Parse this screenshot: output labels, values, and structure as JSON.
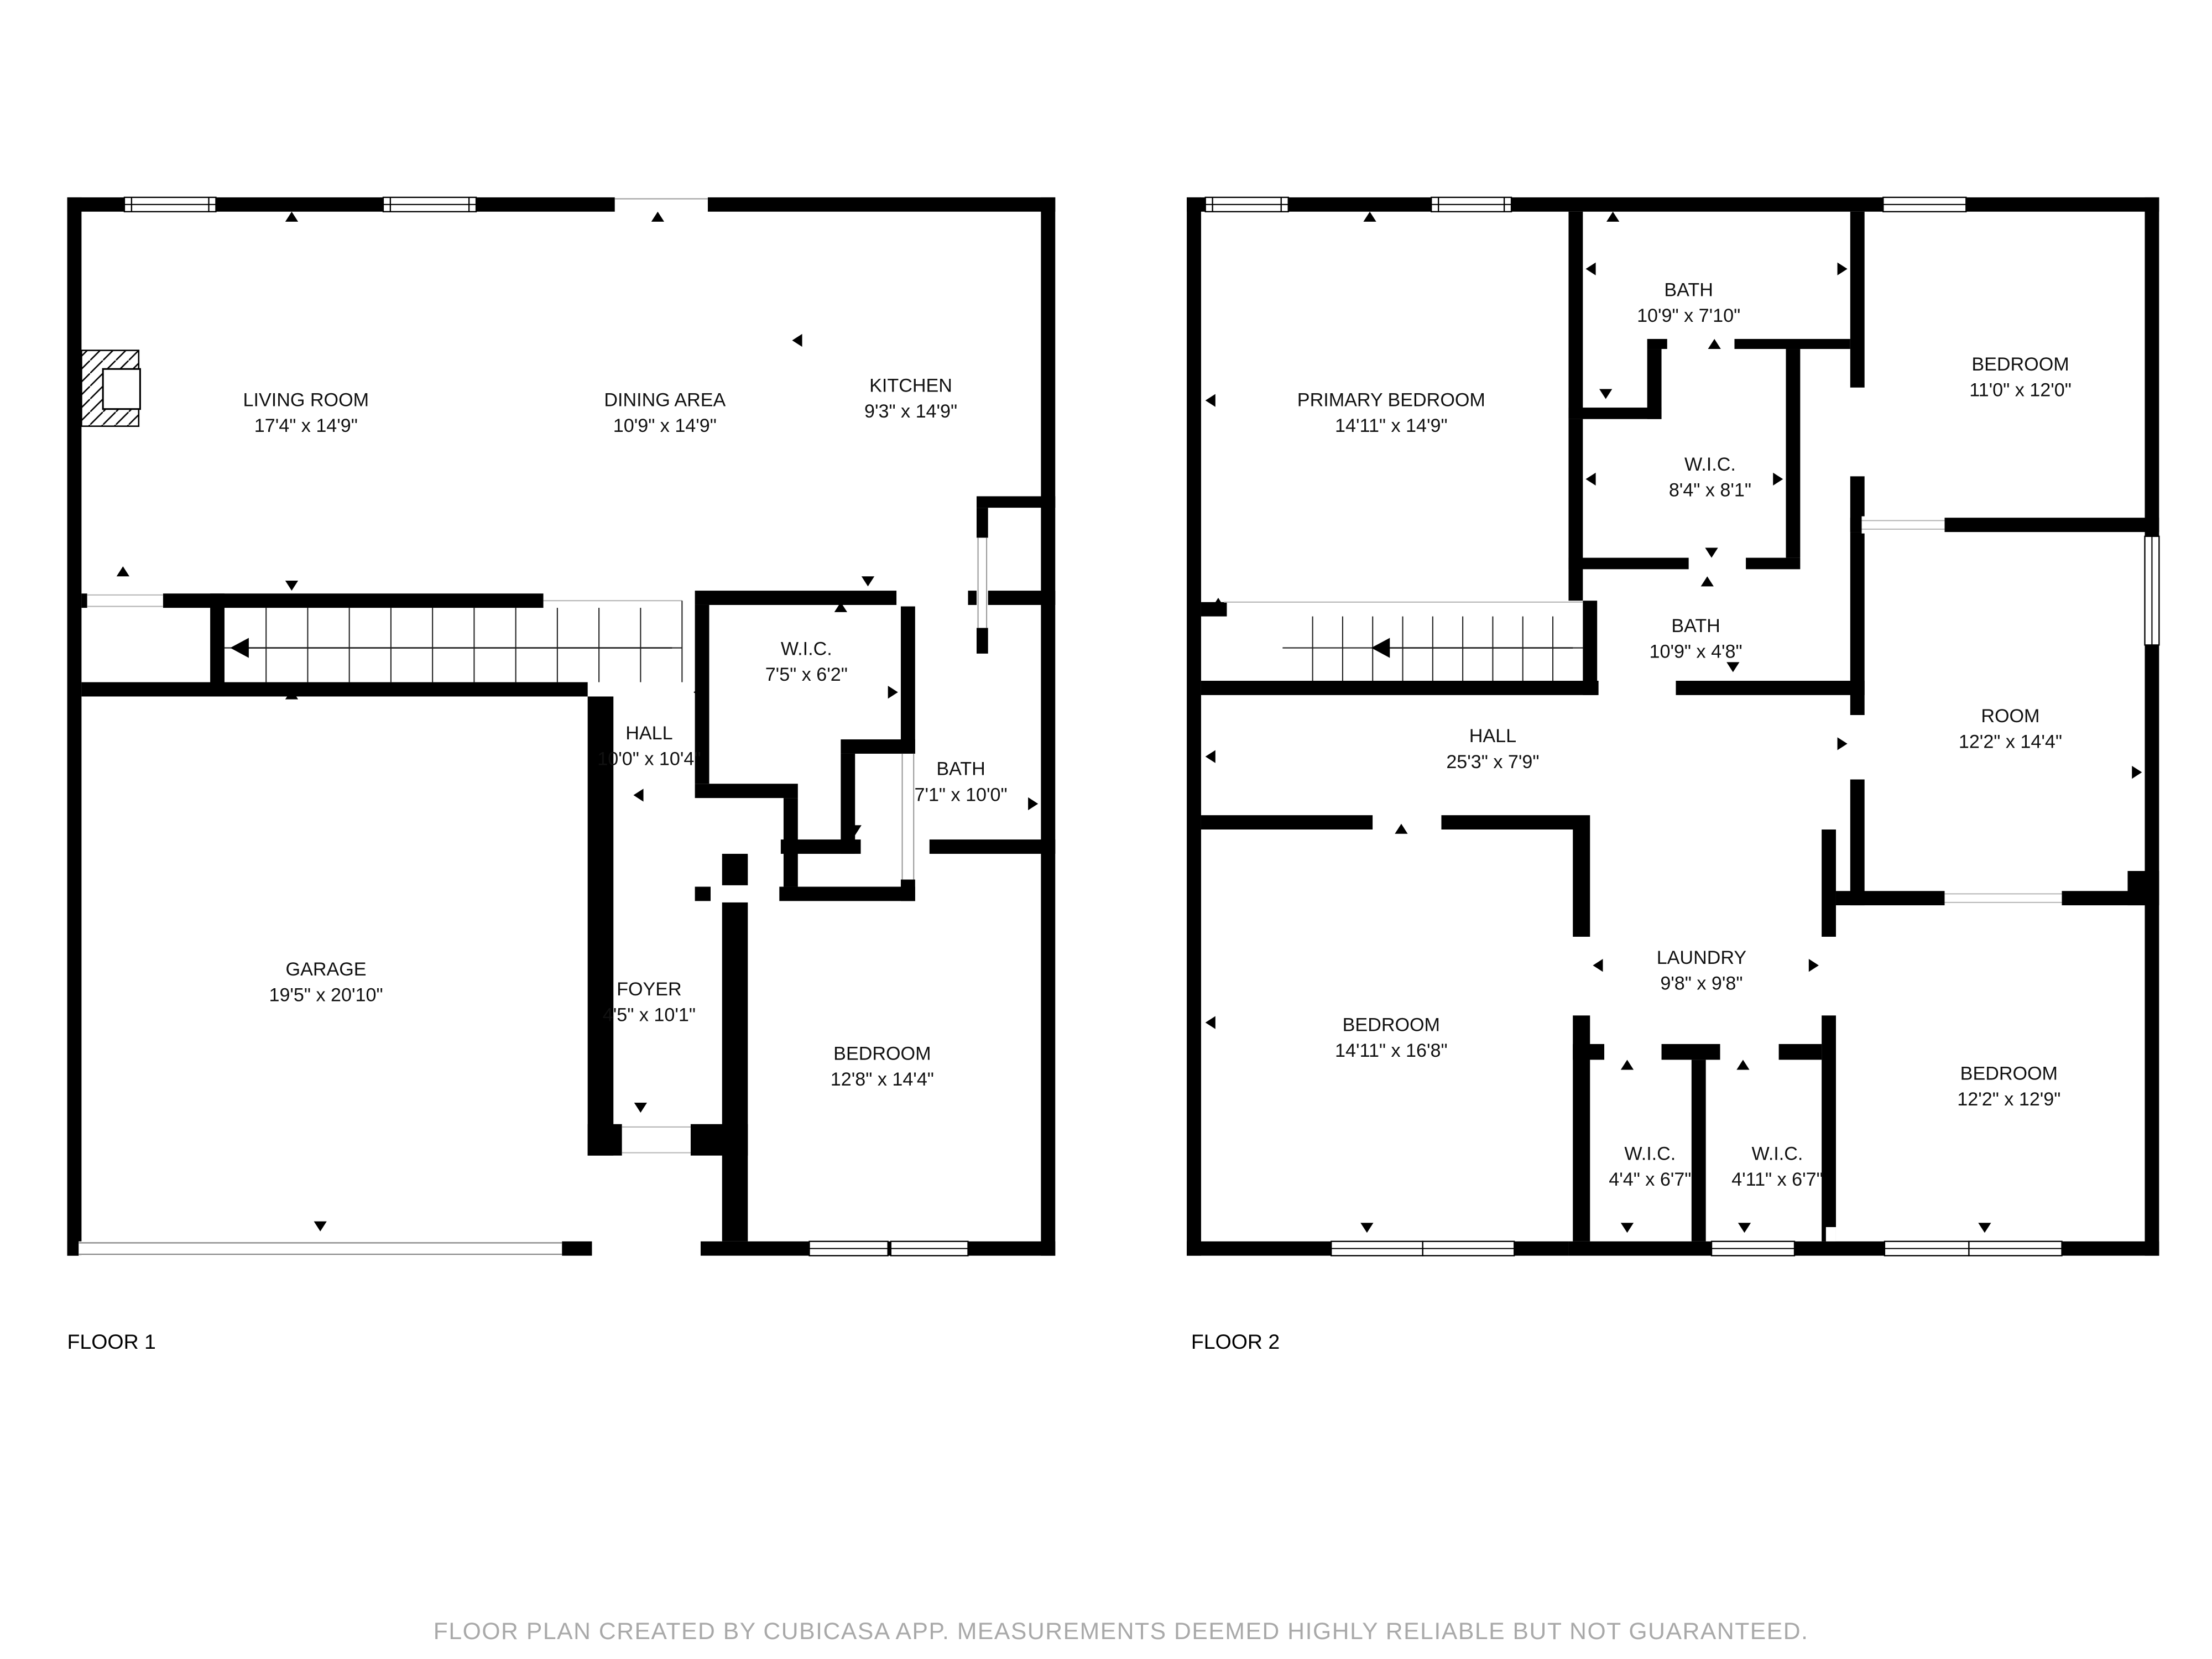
{
  "floors": [
    {
      "label": "FLOOR 1",
      "rooms": [
        {
          "name": "LIVING ROOM",
          "dims": "17'4\" x 14'9\""
        },
        {
          "name": "DINING AREA",
          "dims": "10'9\" x 14'9\""
        },
        {
          "name": "KITCHEN",
          "dims": "9'3\" x 14'9\""
        },
        {
          "name": "W.I.C.",
          "dims": "7'5\" x 6'2\""
        },
        {
          "name": "HALL",
          "dims": "10'0\" x 10'4\""
        },
        {
          "name": "BATH",
          "dims": "7'1\" x 10'0\""
        },
        {
          "name": "GARAGE",
          "dims": "19'5\" x 20'10\""
        },
        {
          "name": "FOYER",
          "dims": "4'5\" x 10'1\""
        },
        {
          "name": "BEDROOM",
          "dims": "12'8\" x 14'4\""
        }
      ]
    },
    {
      "label": "FLOOR 2",
      "rooms": [
        {
          "name": "BATH",
          "dims": "10'9\" x 7'10\""
        },
        {
          "name": "PRIMARY BEDROOM",
          "dims": "14'11\" x 14'9\""
        },
        {
          "name": "BEDROOM",
          "dims": "11'0\" x 12'0\""
        },
        {
          "name": "W.I.C.",
          "dims": "8'4\" x 8'1\""
        },
        {
          "name": "BATH",
          "dims": "10'9\" x 4'8\""
        },
        {
          "name": "HALL",
          "dims": "25'3\" x 7'9\""
        },
        {
          "name": "ROOM",
          "dims": "12'2\" x 14'4\""
        },
        {
          "name": "LAUNDRY",
          "dims": "9'8\" x 9'8\""
        },
        {
          "name": "BEDROOM",
          "dims": "14'11\" x 16'8\""
        },
        {
          "name": "W.I.C.",
          "dims": "4'4\" x 6'7\""
        },
        {
          "name": "W.I.C.",
          "dims": "4'11\" x 6'7\""
        },
        {
          "name": "BEDROOM",
          "dims": "12'2\" x 12'9\""
        }
      ]
    }
  ],
  "footer": {
    "text": "FLOOR PLAN CREATED BY CUBICASA APP. MEASUREMENTS DEEMED HIGHLY RELIABLE BUT NOT GUARANTEED."
  },
  "colors": {
    "wall": "#000000",
    "background": "#ffffff",
    "footer_text": "#a9a9a9"
  }
}
